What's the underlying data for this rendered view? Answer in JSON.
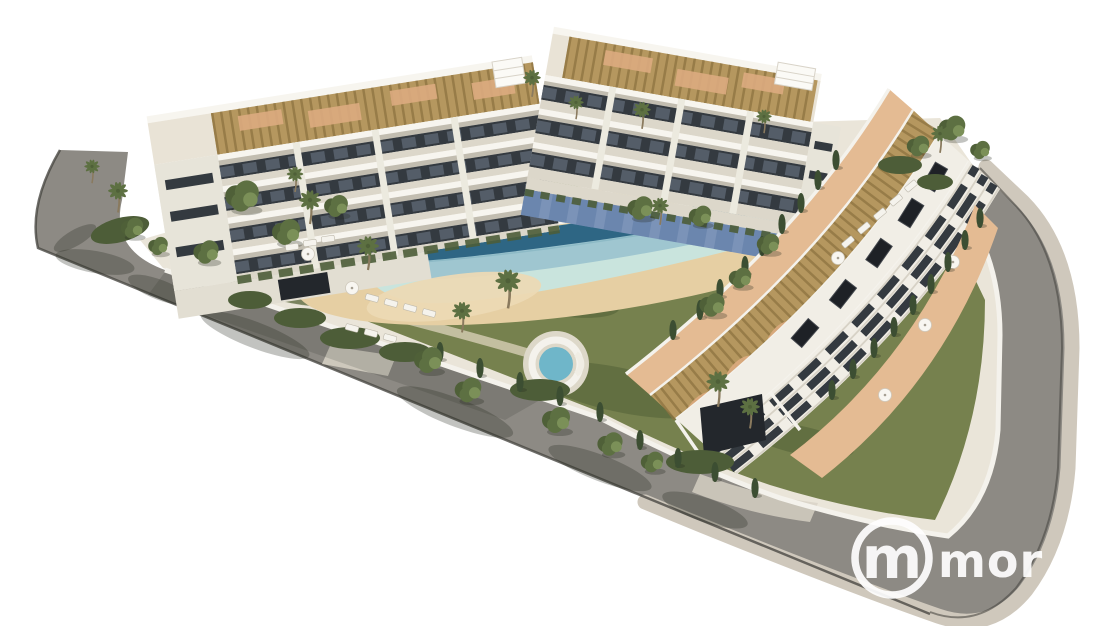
{
  "image": {
    "type": "3d-architectural-render",
    "subject": "Aerial render of a modern white apartment complex with communal lagoon pool, sandy sun deck, gardens and a curved perimeter road",
    "background": "#ffffff"
  },
  "watermark": {
    "logo_letter": "m",
    "text_fragment": "mor",
    "color": "#ffffff"
  },
  "scene": {
    "road": {
      "label": "perimeter asphalt road with tree shadows"
    },
    "sidewalk": {
      "label": "outer sidewalk band"
    },
    "boundary": {
      "label": "white perimeter garden wall"
    },
    "building_left": {
      "label": "west apartment block with rooftop pergolas and balconies"
    },
    "building_top": {
      "label": "north apartment block with rooftop terraces and blue ground-floor patios"
    },
    "building_right": {
      "label": "curved east apartment block with slatted roof pergolas, skylights and street terraces"
    },
    "pool": {
      "label": "lagoon-style pool with raised infinity edge and beach entry"
    },
    "kids_pool": {
      "label": "small round splash pool"
    },
    "jacuzzi": {
      "label": "round spa pool with steps"
    },
    "garden": {
      "label": "lawns, palms, cypresses and hedges"
    },
    "loungers": {
      "label": "white sun loungers"
    },
    "parasols": {
      "label": "white parasols"
    },
    "garage_left": {
      "label": "garage entrance of west block"
    },
    "garage_south": {
      "label": "garage ramp at south corner"
    }
  },
  "palette": {
    "background": "#ffffff",
    "road": "#8d8a84",
    "sidewalk": "#cfc8bc",
    "curb": "#4a4843",
    "boundary_wall": "#f4f2ec",
    "platform": "#eae5d9",
    "grass": "#76814e",
    "grass_dark": "#5e6b3f",
    "sand": "#e6cfa3",
    "beach": "#ecd9b4",
    "path_sand": "#ded4bc",
    "pool_edge_dark": "#2e6684",
    "pool_water": "#9fc6d0",
    "pool_stripe": "#88b6c3",
    "pool_shallow": "#c9e4dd",
    "pool_rim": "#f6f4ee",
    "kids_pool": "#aed4d6",
    "kids_rim": "#88b0b8",
    "jacuzzi": "#6fb6c9",
    "deck": "#ddd8c9",
    "building_face": "#f1eee6",
    "building_side": "#e7e4d9",
    "roof_base": "#e9e3d6",
    "slab": "#f7f5ef",
    "slab_shadow": "#b6b0a3",
    "window": "#343a40",
    "glass": "#5d6772",
    "floor_lower": "#dcd7ca",
    "pier": "#eceadf",
    "podium": "#e2ded2",
    "ground_strip": "#ddd8cb",
    "garage": "#23272c",
    "pergola": "#b5975f",
    "pergola_slat": "#8d7340",
    "terracotta": "#dcab80",
    "terrace_tile": "#e4bb93",
    "patio_blue": "#7b93b8",
    "patio_dark": "#5f7ba6",
    "canopy": "#fbfaf6",
    "apron": "#d8d2c6",
    "hedge": "#4d5d38",
    "tree_dark": "#4f6038",
    "tree_mid": "#5d7042",
    "tree_light": "#7b9058",
    "cypress": "#3c4e32",
    "trunk": "#8a7a5e",
    "lounger": "#f5f3ed",
    "umbrella": "#f8f6f1",
    "hatch": "#1e2126",
    "hatch_edge": "#43474d",
    "steps": "#f0ede4",
    "shadow_soft": "rgba(35,38,30,0.28)",
    "watermark": "#ffffff"
  }
}
